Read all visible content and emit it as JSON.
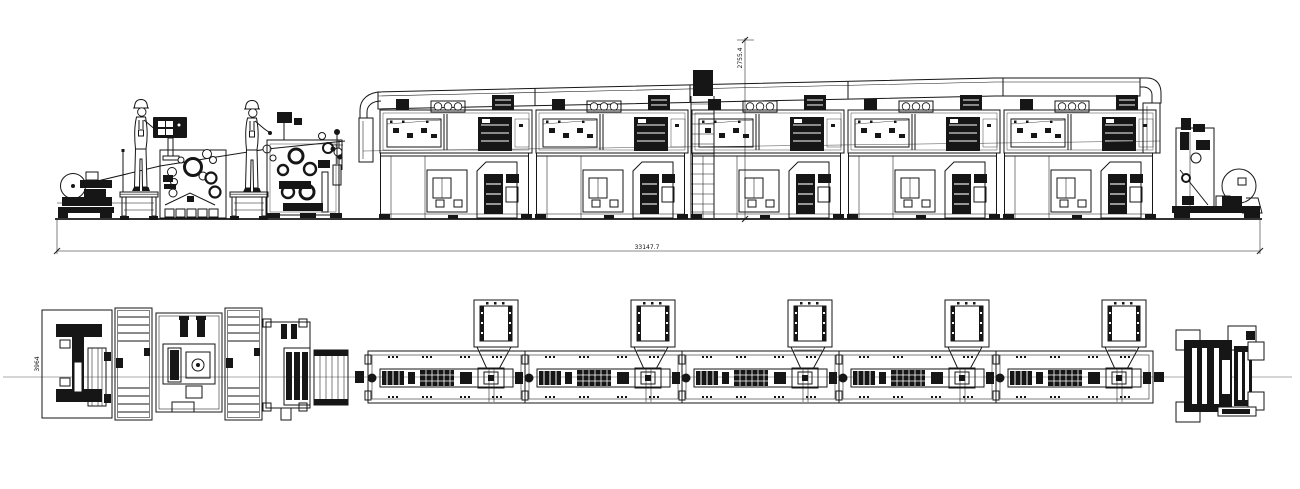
{
  "meta": {
    "background_color": "#ffffff",
    "ink_color": "#161616",
    "centerline_color": "#8f8f8f"
  },
  "annotations": {
    "overall_length": "33147.7",
    "machine_height": "2755.4",
    "machine_width": "3964"
  },
  "views": {
    "elevation": {
      "oven_module_count": 5,
      "worker_count": 2,
      "has_roof_duct": true
    },
    "plan": {
      "oven_module_count": 5,
      "exhaust_hood_count": 5,
      "has_centerline": true
    }
  },
  "icons": {
    "worker": "operator-figure",
    "control_panel": "hmi-control-panel",
    "unwinder": "unwind-roll-stand",
    "rewinder": "rewind-roll-stand",
    "coater_1": "coating-head-unit",
    "coater_2": "printing-laminating-unit",
    "oven_module": "drying-oven-module",
    "roof_duct": "exhaust-duct",
    "hood": "exhaust-hood",
    "platform": "operator-platform",
    "ladder": "access-ladder"
  }
}
